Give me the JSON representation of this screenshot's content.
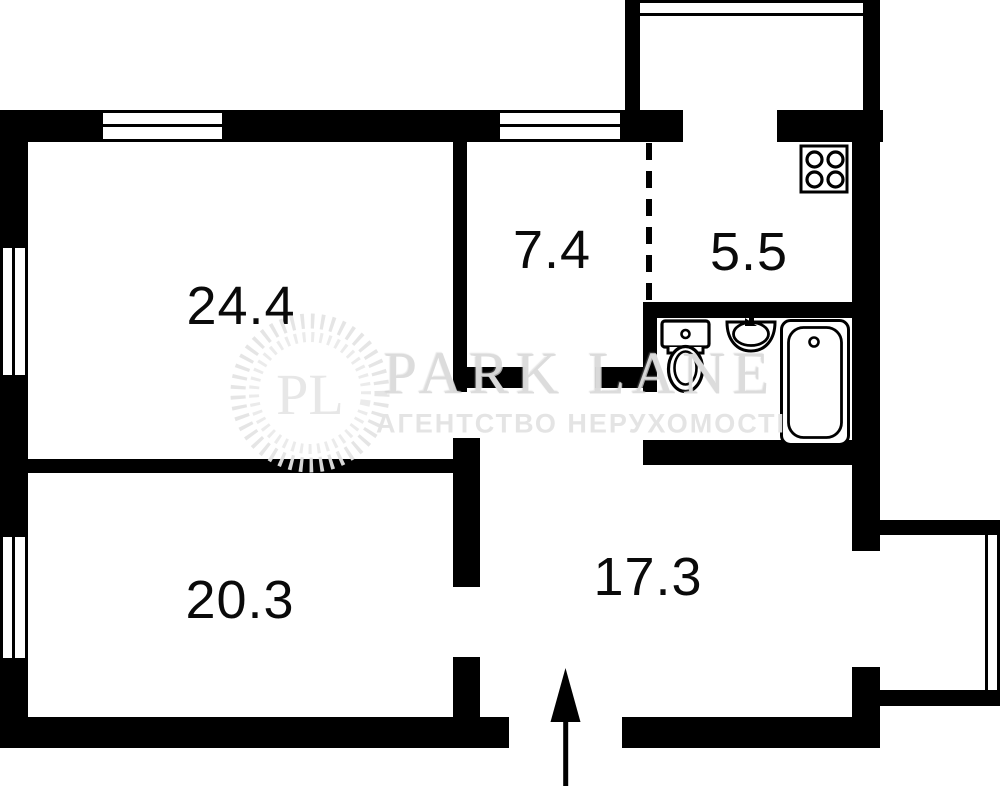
{
  "rooms": [
    {
      "name": "room-24-4",
      "label": "24.4"
    },
    {
      "name": "hallway-7-4",
      "label": "7.4"
    },
    {
      "name": "kitchen-5-5",
      "label": "5.5"
    },
    {
      "name": "room-20-3",
      "label": "20.3"
    },
    {
      "name": "hallway-17-3",
      "label": "17.3"
    }
  ],
  "watermark": {
    "initials": "PL",
    "brand": "PARK LANE",
    "tagline": "АГЕНТСТВО НЕРУХОМОСТІ"
  },
  "colors": {
    "wall": "#000000",
    "background": "#ffffff",
    "watermark_text": "#dadada"
  },
  "icons": {
    "stove": "stove-icon",
    "toilet": "toilet-icon",
    "sink": "sink-icon",
    "bathtub": "bathtub-icon",
    "entrance": "entrance-arrow-icon"
  }
}
